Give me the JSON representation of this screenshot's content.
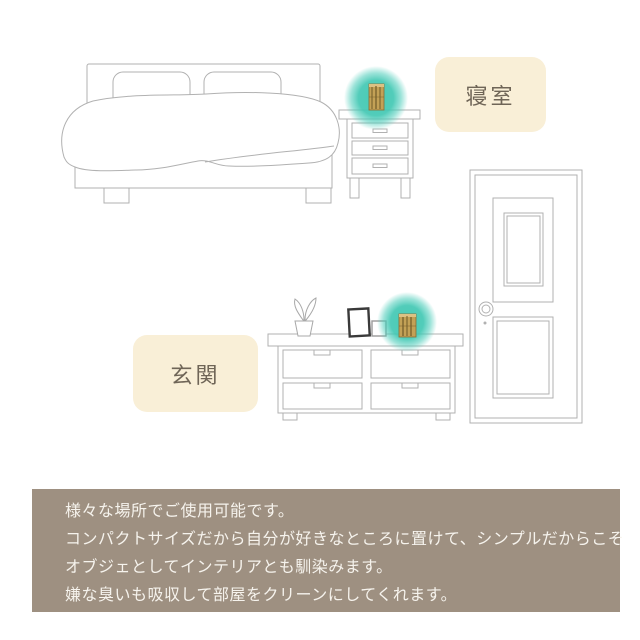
{
  "labels": {
    "bedroom": "寝室",
    "entrance": "玄関"
  },
  "banner": {
    "lines": [
      "様々な場所でご使用可能です。",
      "コンパクトサイズだから自分が好きなところに置けて、シンプルだからこそ",
      "オブジェとしてインテリアとも馴染みます。",
      "嫌な臭いも吸収して部屋をクリーンにしてくれます。"
    ]
  },
  "colors": {
    "accent_teal": "#3fc7b2",
    "label_background": "#f9efd7",
    "label_text": "#6f6557",
    "banner_background": "#9e9081",
    "banner_text": "#f6f3ed",
    "line_gray": "#b1b1b1",
    "picture_frame_dark": "#3a3a3a",
    "product_tan": "#c3a156",
    "product_stripe_brown": "#6f5a28"
  },
  "icons": {
    "bed": "bed-line-illustration",
    "nightstand": "nightstand-line-illustration",
    "door": "door-line-illustration",
    "cabinet": "cabinet-line-illustration",
    "plant": "potted-plant-icon",
    "large_frame": "picture-frame-icon",
    "small_frame": "small-picture-frame-icon",
    "product": "bamboo-charcoal-deodorizer-icon",
    "highlight": "teal-highlight-circle"
  }
}
